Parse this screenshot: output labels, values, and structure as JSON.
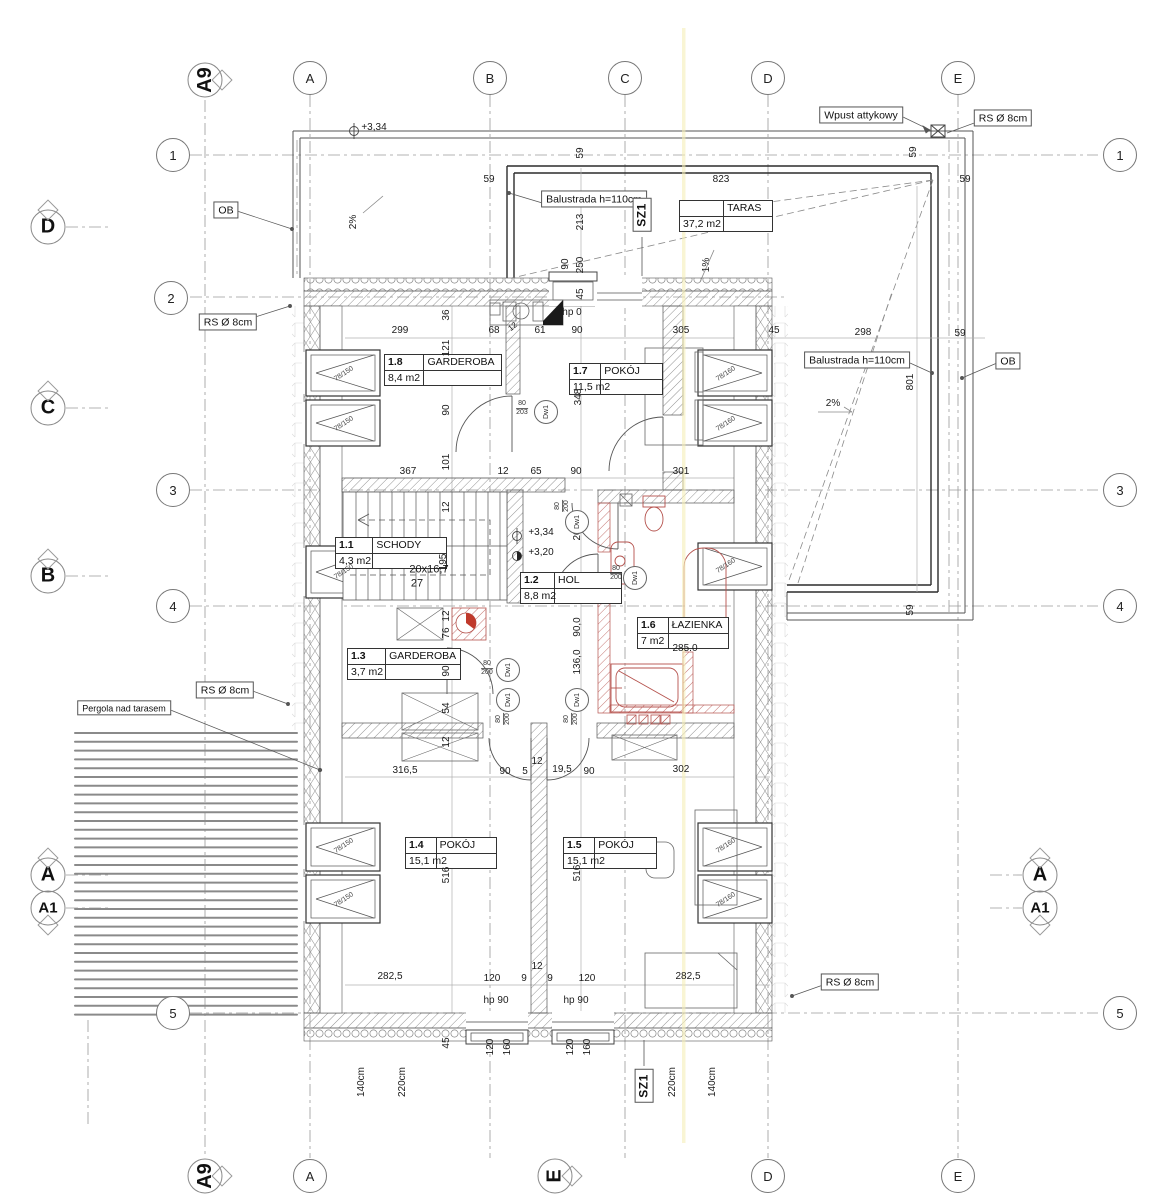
{
  "colors": {
    "line": "#555555",
    "red_fixture": "#b5524d",
    "yellow_fold": "#f5eeb8",
    "wall_dark": "#333333"
  },
  "drawing": {
    "grid_bubbles": [
      {
        "t": "A",
        "x": 310,
        "y": 78
      },
      {
        "t": "B",
        "x": 490,
        "y": 78
      },
      {
        "t": "C",
        "x": 625,
        "y": 78
      },
      {
        "t": "D",
        "x": 768,
        "y": 78
      },
      {
        "t": "E",
        "x": 958,
        "y": 78
      },
      {
        "t": "A",
        "x": 310,
        "y": 1176
      },
      {
        "t": "D",
        "x": 768,
        "y": 1176
      },
      {
        "t": "E",
        "x": 958,
        "y": 1176
      },
      {
        "t": "1",
        "x": 173,
        "y": 155
      },
      {
        "t": "2",
        "x": 171,
        "y": 298
      },
      {
        "t": "3",
        "x": 173,
        "y": 490
      },
      {
        "t": "4",
        "x": 173,
        "y": 606
      },
      {
        "t": "5",
        "x": 173,
        "y": 1013
      },
      {
        "t": "1",
        "x": 1120,
        "y": 155
      },
      {
        "t": "3",
        "x": 1120,
        "y": 490
      },
      {
        "t": "4",
        "x": 1120,
        "y": 606
      },
      {
        "t": "5",
        "x": 1120,
        "y": 1013
      }
    ],
    "section_markers": [
      {
        "t": "D",
        "x": 48,
        "y": 227,
        "tri": "up"
      },
      {
        "t": "C",
        "x": 48,
        "y": 408,
        "tri": "up"
      },
      {
        "t": "B",
        "x": 48,
        "y": 576,
        "tri": "up"
      },
      {
        "t": "A",
        "x": 48,
        "y": 875,
        "tri": "up"
      },
      {
        "t": "A1",
        "x": 48,
        "y": 908,
        "tri": "down",
        "small": true
      },
      {
        "t": "A",
        "x": 1040,
        "y": 875,
        "tri": "up"
      },
      {
        "t": "A1",
        "x": 1040,
        "y": 908,
        "tri": "down",
        "small": true
      },
      {
        "t": "A9",
        "x": 205,
        "y": 80,
        "rot": true,
        "tri": "right"
      },
      {
        "t": "A9",
        "x": 205,
        "y": 1176,
        "rot": true,
        "tri": "right"
      },
      {
        "t": "E",
        "x": 555,
        "y": 1176,
        "rot": true,
        "tri": "right"
      }
    ],
    "room_tables": [
      {
        "id": "1.8",
        "name": "GARDEROBA",
        "area": "8,4 m2",
        "x": 384,
        "y": 354,
        "w": 116
      },
      {
        "id": "1.7",
        "name": "POKÓJ",
        "area": "11,5 m2",
        "x": 569,
        "y": 363,
        "w": 92
      },
      {
        "id": "1.1",
        "name": "SCHODY",
        "area": "4,3 m2",
        "x": 335,
        "y": 537,
        "w": 110
      },
      {
        "id": "1.2",
        "name": "HOL",
        "area": "8,8 m2",
        "x": 520,
        "y": 572,
        "w": 100
      },
      {
        "id": "1.6",
        "name": "ŁAZIENKA",
        "area": "7 m2",
        "x": 637,
        "y": 617,
        "w": 90
      },
      {
        "id": "1.3",
        "name": "GARDEROBA",
        "area": "3,7 m2",
        "x": 347,
        "y": 648,
        "w": 112
      },
      {
        "id": "1.4",
        "name": "POKÓJ",
        "area": "15,1 m2",
        "x": 405,
        "y": 837,
        "w": 90
      },
      {
        "id": "1.5",
        "name": "POKÓJ",
        "area": "15,1 m2",
        "x": 563,
        "y": 837,
        "w": 92
      }
    ],
    "area_table": {
      "name": "TARAS",
      "area": "37,2 m2",
      "x": 679,
      "y": 200,
      "w": 92
    },
    "boxed_notes": [
      {
        "t": "OB",
        "x": 226,
        "y": 210
      },
      {
        "t": "RS Ø 8cm",
        "x": 228,
        "y": 322
      },
      {
        "t": "RS Ø 8cm",
        "x": 225,
        "y": 690
      },
      {
        "t": "RS Ø 8cm",
        "x": 1003,
        "y": 118
      },
      {
        "t": "RS Ø 8cm",
        "x": 850,
        "y": 982
      },
      {
        "t": "Wpust attykowy",
        "x": 861,
        "y": 115
      },
      {
        "t": "Balustrada h=110cm",
        "x": 594,
        "y": 199
      },
      {
        "t": "Balustrada h=110cm",
        "x": 857,
        "y": 360
      },
      {
        "t": "OB",
        "x": 1008,
        "y": 361
      },
      {
        "t": "Pergola nad tarasem",
        "x": 124,
        "y": 708,
        "s": 9
      },
      {
        "t": "SZ1",
        "x": 642,
        "y": 215,
        "r": -90,
        "b": true
      },
      {
        "t": "SZ1",
        "x": 644,
        "y": 1086,
        "r": -90,
        "b": true
      }
    ],
    "annotations": [
      {
        "t": "+3,34",
        "x": 374,
        "y": 128
      },
      {
        "t": "823",
        "x": 721,
        "y": 180
      },
      {
        "t": "59",
        "x": 489,
        "y": 180
      },
      {
        "t": "59",
        "x": 965,
        "y": 180
      },
      {
        "t": "59",
        "x": 581,
        "y": 153,
        "r": -90
      },
      {
        "t": "59",
        "x": 914,
        "y": 152,
        "r": -90
      },
      {
        "t": "213",
        "x": 581,
        "y": 222,
        "r": -90
      },
      {
        "t": "90",
        "x": 566,
        "y": 264,
        "r": -90
      },
      {
        "t": "250",
        "x": 581,
        "y": 265,
        "r": -90
      },
      {
        "t": "45",
        "x": 581,
        "y": 294,
        "r": -90
      },
      {
        "t": "hp 0",
        "x": 572,
        "y": 313
      },
      {
        "t": "1%",
        "x": 707,
        "y": 265,
        "r": -90
      },
      {
        "t": "2%",
        "x": 354,
        "y": 222,
        "r": -90
      },
      {
        "t": "2%",
        "x": 833,
        "y": 404
      },
      {
        "t": "298",
        "x": 863,
        "y": 333
      },
      {
        "t": "59",
        "x": 960,
        "y": 334
      },
      {
        "t": "801",
        "x": 911,
        "y": 382,
        "r": -90
      },
      {
        "t": "59",
        "x": 911,
        "y": 610,
        "r": -90
      },
      {
        "t": "299",
        "x": 400,
        "y": 331
      },
      {
        "t": "68",
        "x": 494,
        "y": 331
      },
      {
        "t": "61",
        "x": 540,
        "y": 331
      },
      {
        "t": "90",
        "x": 577,
        "y": 331
      },
      {
        "t": "305",
        "x": 681,
        "y": 331
      },
      {
        "t": "45",
        "x": 774,
        "y": 331
      },
      {
        "t": "12",
        "x": 513,
        "y": 327,
        "r": -40,
        "s": 8
      },
      {
        "t": "36",
        "x": 447,
        "y": 315,
        "r": -90
      },
      {
        "t": "121",
        "x": 447,
        "y": 348,
        "r": -90
      },
      {
        "t": "348",
        "x": 579,
        "y": 397,
        "r": -90
      },
      {
        "t": "90",
        "x": 447,
        "y": 410,
        "r": -90
      },
      {
        "t": "367",
        "x": 408,
        "y": 472
      },
      {
        "t": "101",
        "x": 447,
        "y": 462,
        "r": -90
      },
      {
        "t": "12",
        "x": 503,
        "y": 472
      },
      {
        "t": "65",
        "x": 536,
        "y": 472
      },
      {
        "t": "90",
        "x": 576,
        "y": 472
      },
      {
        "t": "301",
        "x": 681,
        "y": 472
      },
      {
        "t": "12",
        "x": 447,
        "y": 507,
        "r": -90
      },
      {
        "t": "195",
        "x": 444,
        "y": 562,
        "r": -90
      },
      {
        "t": "20x16,7",
        "x": 429,
        "y": 570,
        "s": 11
      },
      {
        "t": "27",
        "x": 417,
        "y": 584,
        "s": 11
      },
      {
        "t": "+3,34",
        "x": 541,
        "y": 533
      },
      {
        "t": "+3,20",
        "x": 541,
        "y": 553
      },
      {
        "t": "206,0",
        "x": 578,
        "y": 528,
        "r": -90
      },
      {
        "t": "90,0",
        "x": 578,
        "y": 627,
        "r": -90
      },
      {
        "t": "136,0",
        "x": 578,
        "y": 662,
        "r": -90
      },
      {
        "t": "285.0",
        "x": 685,
        "y": 649
      },
      {
        "t": "12",
        "x": 447,
        "y": 616,
        "r": -90
      },
      {
        "t": "76",
        "x": 447,
        "y": 633,
        "r": -90
      },
      {
        "t": "90",
        "x": 447,
        "y": 671,
        "r": -90
      },
      {
        "t": "54",
        "x": 447,
        "y": 708,
        "r": -90
      },
      {
        "t": "12",
        "x": 447,
        "y": 742,
        "r": -90
      },
      {
        "t": "316,5",
        "x": 405,
        "y": 771
      },
      {
        "t": "90",
        "x": 505,
        "y": 772
      },
      {
        "t": "5",
        "x": 525,
        "y": 772
      },
      {
        "t": "12",
        "x": 537,
        "y": 762
      },
      {
        "t": "19,5",
        "x": 562,
        "y": 770
      },
      {
        "t": "90",
        "x": 589,
        "y": 772
      },
      {
        "t": "302",
        "x": 681,
        "y": 770
      },
      {
        "t": "516",
        "x": 447,
        "y": 875,
        "r": -90
      },
      {
        "t": "516",
        "x": 578,
        "y": 873,
        "r": -90
      },
      {
        "t": "282,5",
        "x": 390,
        "y": 977
      },
      {
        "t": "120",
        "x": 492,
        "y": 979
      },
      {
        "t": "9",
        "x": 524,
        "y": 979
      },
      {
        "t": "12",
        "x": 537,
        "y": 967
      },
      {
        "t": "9",
        "x": 550,
        "y": 979
      },
      {
        "t": "120",
        "x": 587,
        "y": 979
      },
      {
        "t": "282,5",
        "x": 688,
        "y": 977
      },
      {
        "t": "hp 90",
        "x": 496,
        "y": 1001
      },
      {
        "t": "hp 90",
        "x": 576,
        "y": 1001
      },
      {
        "t": "45",
        "x": 447,
        "y": 1043,
        "r": -90
      },
      {
        "t": "120",
        "x": 491,
        "y": 1047,
        "r": -90
      },
      {
        "t": "160",
        "x": 508,
        "y": 1047,
        "r": -90
      },
      {
        "t": "120",
        "x": 571,
        "y": 1047,
        "r": -90
      },
      {
        "t": "160",
        "x": 588,
        "y": 1047,
        "r": -90
      },
      {
        "t": "140cm",
        "x": 362,
        "y": 1082,
        "r": -90
      },
      {
        "t": "220cm",
        "x": 403,
        "y": 1082,
        "r": -90
      },
      {
        "t": "220cm",
        "x": 673,
        "y": 1082,
        "r": -90
      },
      {
        "t": "140cm",
        "x": 713,
        "y": 1082,
        "r": -90
      }
    ],
    "door_tags": [
      {
        "t": "Dw1",
        "x": 546,
        "y": 412
      },
      {
        "t": "Dw1",
        "x": 577,
        "y": 522
      },
      {
        "t": "Dw1",
        "x": 635,
        "y": 578
      },
      {
        "t": "Dw1",
        "x": 508,
        "y": 670
      },
      {
        "t": "Dw1",
        "x": 508,
        "y": 700
      },
      {
        "t": "Dw1",
        "x": 577,
        "y": 700
      }
    ],
    "door_sizes": [
      {
        "a": "80",
        "b": "203",
        "x": 522,
        "y": 409
      },
      {
        "a": "80",
        "b": "200",
        "x": 563,
        "y": 506,
        "r": -90
      },
      {
        "a": "80",
        "b": "200",
        "x": 616,
        "y": 574
      },
      {
        "a": "80",
        "b": "200",
        "x": 487,
        "y": 669
      },
      {
        "a": "80",
        "b": "200",
        "x": 504,
        "y": 719,
        "r": -90
      },
      {
        "a": "80",
        "b": "200",
        "x": 572,
        "y": 719,
        "r": -90
      }
    ],
    "window_tags": [
      {
        "t": "78/150",
        "x": 344,
        "y": 374
      },
      {
        "t": "78/150",
        "x": 344,
        "y": 424
      },
      {
        "t": "78/150",
        "x": 344,
        "y": 572
      },
      {
        "t": "78/150",
        "x": 344,
        "y": 846
      },
      {
        "t": "78/150",
        "x": 344,
        "y": 900
      },
      {
        "t": "78/160",
        "x": 726,
        "y": 374
      },
      {
        "t": "78/160",
        "x": 726,
        "y": 424
      },
      {
        "t": "78/160",
        "x": 726,
        "y": 566
      },
      {
        "t": "78/160",
        "x": 726,
        "y": 846
      },
      {
        "t": "78/160",
        "x": 726,
        "y": 900
      }
    ]
  }
}
